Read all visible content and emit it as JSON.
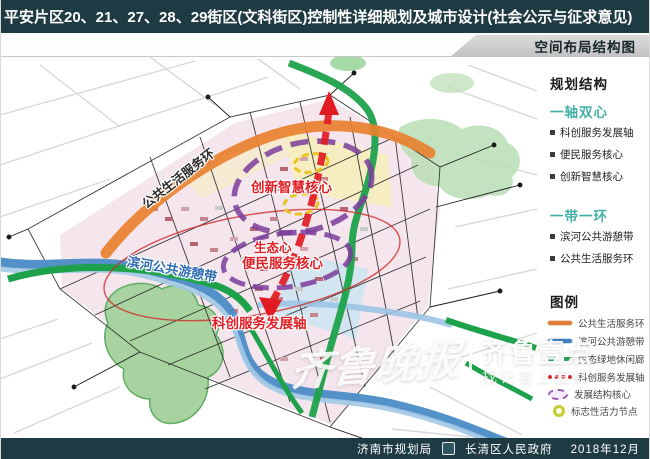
{
  "header": {
    "title": "平安片区20、21、27、28、29街区(文科街区)控制性详细规划及城市设计(社会公示与征求意见)",
    "subtitle": "空间布局结构图"
  },
  "panel": {
    "structure_heading": "规划结构",
    "sections": [
      {
        "heading": "一轴双心",
        "items": [
          "科创服务发展轴",
          "便民服务核心",
          "创新智慧核心"
        ]
      },
      {
        "heading": "一带一环",
        "items": [
          "滨河公共游憩带",
          "公共生活服务环"
        ]
      }
    ],
    "legend_heading": "图例",
    "legend": [
      {
        "label": "公共生活服务环",
        "icon": "orange-line",
        "color": "#e0813a"
      },
      {
        "label": "滨河公共游憩带",
        "icon": "blue-line",
        "color": "#3f7fbf"
      },
      {
        "label": "生态绿地休闲廊",
        "icon": "green-dashes",
        "color": "#2ea04e"
      },
      {
        "label": "科创服务发展轴",
        "icon": "red-dashes",
        "color": "#d43030"
      },
      {
        "label": "发展结构核心",
        "icon": "purple-dashed-ellipse",
        "color": "#9b59b6"
      },
      {
        "label": "标志性活力节点",
        "icon": "yellow-circle",
        "color": "#c3cf2e"
      }
    ]
  },
  "map": {
    "labels": {
      "innovation_core": "创新智慧核心",
      "eco_heart": "生态心",
      "service_core": "便民服务核心",
      "life_ring": "公共生活服务环",
      "river_belt": "滨河公共游憩带",
      "tech_axis": "科创服务发展轴"
    },
    "colors": {
      "axis_red": "#e01b22",
      "core_purple": "#7a3d9b",
      "node_yellow": "#e9c422",
      "ring_orange": "#e8812f",
      "river_blue": "#4a8cc6",
      "green_belt": "#1da24b",
      "park_green": "#a8d3a0"
    }
  },
  "watermark": {
    "script": "齐鲁晚报",
    "brand": "齐鲁壹点",
    "tagline": "找记者上壹点"
  },
  "footer": {
    "agency1": "济南市规划局",
    "agency2": "长清区人民政府",
    "date": "2018年12月"
  }
}
